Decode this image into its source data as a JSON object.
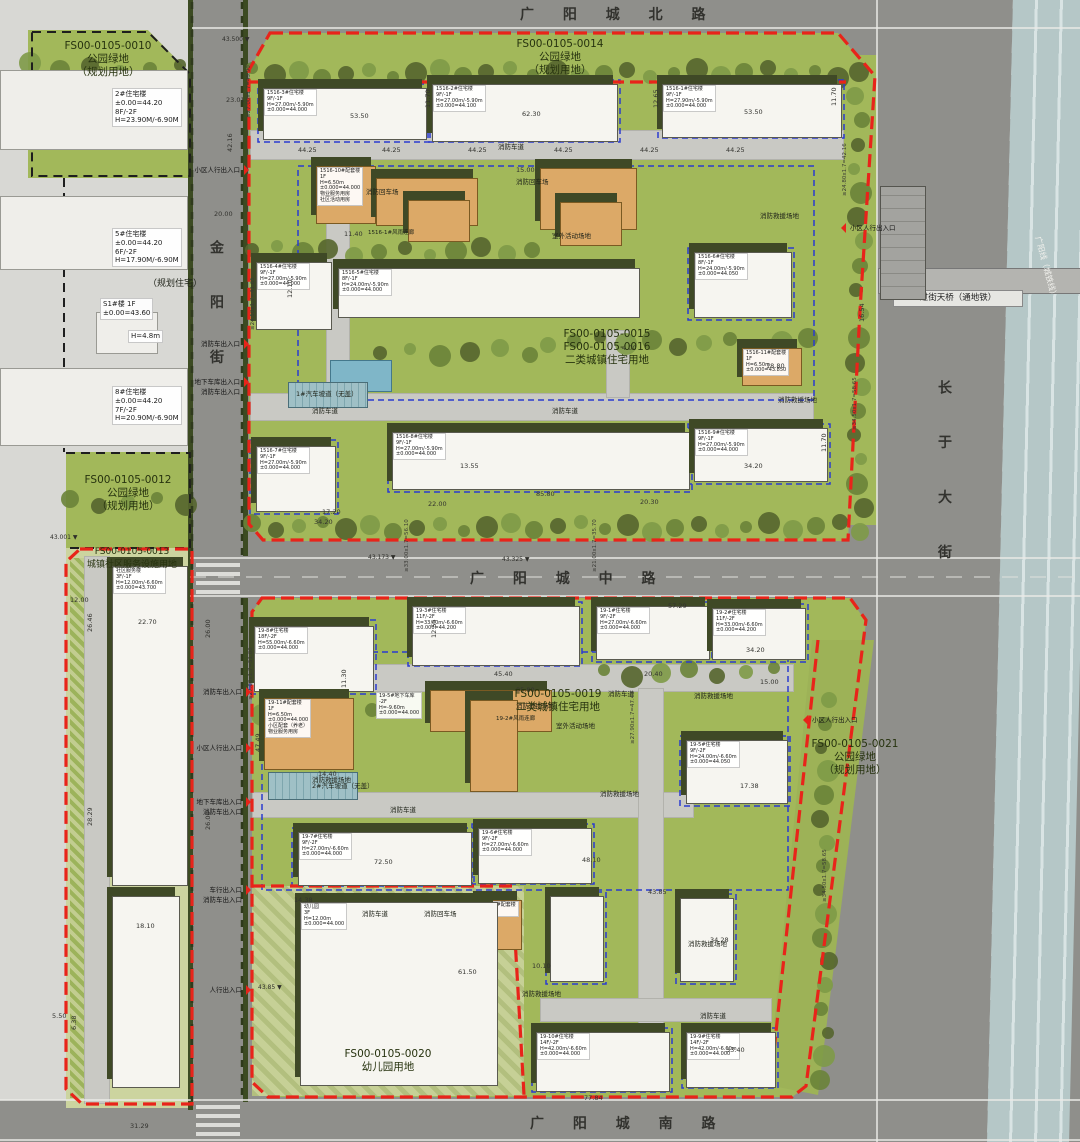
{
  "roads": {
    "north": "广 阳 城 北 路",
    "middle": "广 阳 城 中 路",
    "south": "广 阳 城 南 路",
    "west": "金 阳 街",
    "east": "长 于 大 街",
    "bridge": "过街天桥（通地铁）",
    "rail": "广阳线（城铁线）"
  },
  "parcels": [
    {
      "x": 108,
      "y": 40,
      "lines": [
        "FS00-0105-0010",
        "公园绿地",
        "（规划用地）"
      ]
    },
    {
      "x": 560,
      "y": 38,
      "lines": [
        "FS00-0105-0014",
        "公园绿地",
        "（规划用地）"
      ]
    },
    {
      "x": 607,
      "y": 328,
      "lines": [
        "FS00-0105-0015",
        "FS00-0105-0016",
        "二类城镇住宅用地"
      ]
    },
    {
      "x": 128,
      "y": 474,
      "lines": [
        "FS00-0105-0012",
        "公园绿地",
        "（规划用地）"
      ]
    },
    {
      "x": 132,
      "y": 546,
      "fs": 9,
      "lines": [
        "FS00-0105-0013",
        "城镇社区服务设施用地"
      ]
    },
    {
      "x": 558,
      "y": 688,
      "lines": [
        "FS00-0105-0019",
        "二类城镇住宅用地"
      ]
    },
    {
      "x": 388,
      "y": 1048,
      "lines": [
        "FS00-0105-0020",
        "幼儿园用地"
      ]
    },
    {
      "x": 855,
      "y": 738,
      "lines": [
        "FS00-0105-0021",
        "公园绿地",
        "（规划用地）"
      ]
    }
  ],
  "buildings": [
    {
      "x": 263,
      "y": 88,
      "w": 162,
      "h": 50,
      "c": "w",
      "lines": [
        "1516-3#住宅楼",
        "9F/-1F",
        "H=27.00m/-5.90m",
        "±0.000=44.000"
      ]
    },
    {
      "x": 432,
      "y": 84,
      "w": 184,
      "h": 56,
      "c": "w",
      "lines": [
        "1516-2#住宅楼",
        "9F/-1F",
        "H=27.00m/-5.90m",
        "±0.000=44.100"
      ]
    },
    {
      "x": 662,
      "y": 84,
      "w": 178,
      "h": 52,
      "c": "w",
      "lines": [
        "1516-1#住宅楼",
        "9F/-1F",
        "H=27.90m/-5.90m",
        "±0.000=44.000"
      ]
    },
    {
      "x": 256,
      "y": 262,
      "w": 74,
      "h": 66,
      "c": "w",
      "lines": [
        "1516-4#住宅楼",
        "9F/-1F",
        "H=27.00m/-5.90m",
        "±0.000=44.000"
      ]
    },
    {
      "x": 338,
      "y": 268,
      "w": 300,
      "h": 48,
      "c": "w",
      "lines": [
        "1516-5#住宅楼",
        "8F/-1F",
        "H=24.00m/-5.90m",
        "±0.000=44.000"
      ]
    },
    {
      "x": 694,
      "y": 252,
      "w": 96,
      "h": 64,
      "c": "w",
      "lines": [
        "1516-6#住宅楼",
        "8F/-1F",
        "H=24.00m/-5.90m",
        "±0.000=44.050"
      ]
    },
    {
      "x": 256,
      "y": 446,
      "w": 78,
      "h": 64,
      "c": "w",
      "lines": [
        "1516-7#住宅楼",
        "9F/-1F",
        "H=27.00m/-5.90m",
        "±0.000=44.000"
      ]
    },
    {
      "x": 392,
      "y": 432,
      "w": 296,
      "h": 56,
      "c": "w",
      "lines": [
        "1516-8#住宅楼",
        "9F/-1F",
        "H=27.00m/-5.90m",
        "±0.000=44.000"
      ]
    },
    {
      "x": 694,
      "y": 428,
      "w": 132,
      "h": 52,
      "c": "w",
      "lines": [
        "1516-9#住宅楼",
        "9F/-1F",
        "H=27.00m/-5.90m",
        "±0.000=44.000"
      ]
    },
    {
      "x": 316,
      "y": 166,
      "w": 58,
      "h": 56,
      "c": "o",
      "lines": [
        "1516-10#配套楼",
        "1F",
        "H=6.50m",
        "±0.000=44.000",
        "物业服务用房",
        "社区活动用房"
      ]
    },
    {
      "x": 376,
      "y": 178,
      "w": 100,
      "h": 46,
      "c": "o"
    },
    {
      "x": 408,
      "y": 200,
      "w": 60,
      "h": 40,
      "c": "o"
    },
    {
      "x": 540,
      "y": 168,
      "w": 95,
      "h": 60,
      "c": "o"
    },
    {
      "x": 560,
      "y": 202,
      "w": 60,
      "h": 42,
      "c": "o"
    },
    {
      "x": 742,
      "y": 348,
      "w": 58,
      "h": 36,
      "c": "o",
      "lines": [
        "1516-11#配套楼",
        "1F",
        "H=6.50m",
        "±0.000=43.850"
      ]
    },
    {
      "x": 330,
      "y": 360,
      "w": 60,
      "h": 30,
      "c": "pool"
    },
    {
      "x": 288,
      "y": 382,
      "w": 78,
      "h": 24,
      "c": "ramp"
    },
    {
      "x": 254,
      "y": 626,
      "w": 118,
      "h": 64,
      "c": "w",
      "lines": [
        "19-8#住宅楼",
        "18F/-2F",
        "H=55.00m/-6.60m",
        "±0.000=44.000"
      ]
    },
    {
      "x": 412,
      "y": 606,
      "w": 166,
      "h": 58,
      "c": "w",
      "lines": [
        "19-3#住宅楼",
        "11F/-2F",
        "H=33.00m/-6.60m",
        "±0.000=44.200"
      ]
    },
    {
      "x": 596,
      "y": 606,
      "w": 112,
      "h": 52,
      "c": "w",
      "lines": [
        "19-1#住宅楼",
        "9F/-2F",
        "H=27.00m/-6.60m",
        "±0.000=44.000"
      ]
    },
    {
      "x": 712,
      "y": 608,
      "w": 92,
      "h": 50,
      "c": "w",
      "lines": [
        "19-2#住宅楼",
        "11F/-2F",
        "H=33.00m/-6.60m",
        "±0.000=44.200"
      ]
    },
    {
      "x": 686,
      "y": 740,
      "w": 100,
      "h": 62,
      "c": "w",
      "lines": [
        "19-5#住宅楼",
        "9F/-2F",
        "H=24.00m/-6.60m",
        "±0.000=44.050"
      ]
    },
    {
      "x": 298,
      "y": 832,
      "w": 172,
      "h": 52,
      "c": "w",
      "lines": [
        "19-7#住宅楼",
        "9F/-2F",
        "H=27.00m/-6.60m",
        "±0.000=44.000"
      ]
    },
    {
      "x": 478,
      "y": 828,
      "w": 112,
      "h": 54,
      "c": "w",
      "lines": [
        "19-6#住宅楼",
        "9F/-2F",
        "H=27.00m/-6.60m",
        "±0.000=44.000"
      ]
    },
    {
      "x": 550,
      "y": 896,
      "w": 52,
      "h": 84,
      "c": "w"
    },
    {
      "x": 680,
      "y": 898,
      "w": 52,
      "h": 82,
      "c": "w"
    },
    {
      "x": 536,
      "y": 1032,
      "w": 132,
      "h": 58,
      "c": "w",
      "lines": [
        "19-10#住宅楼",
        "14F/-2F",
        "H=42.00m/-6.60m",
        "±0.000=44.000"
      ]
    },
    {
      "x": 686,
      "y": 1032,
      "w": 88,
      "h": 54,
      "c": "w",
      "lines": [
        "19-9#住宅楼",
        "14F/-2F",
        "H=42.00m/-6.60m",
        "±0.000=44.000"
      ]
    },
    {
      "x": 264,
      "y": 698,
      "w": 88,
      "h": 70,
      "c": "o",
      "lines": [
        "19-11#配套楼",
        "1F",
        "H=6.50m",
        "±0.000=44.000",
        "小区配套（养老）",
        "物业服务用房"
      ]
    },
    {
      "x": 430,
      "y": 690,
      "w": 120,
      "h": 40,
      "c": "o"
    },
    {
      "x": 470,
      "y": 700,
      "w": 46,
      "h": 90,
      "c": "o"
    },
    {
      "x": 478,
      "y": 900,
      "w": 42,
      "h": 48,
      "c": "o",
      "lines": [
        "19-12#配套楼",
        "1F"
      ]
    },
    {
      "x": 268,
      "y": 772,
      "w": 88,
      "h": 26,
      "c": "ramp"
    },
    {
      "x": 300,
      "y": 902,
      "w": 196,
      "h": 182,
      "c": "w",
      "lines": [
        "幼儿园",
        "3F",
        "H=12.00m",
        "±0.000=44.000"
      ]
    },
    {
      "x": 112,
      "y": 566,
      "w": 74,
      "h": 318,
      "c": "w",
      "lines": [
        "社区服务楼",
        "3F/-1F",
        "H=12.00m/-6.60m",
        "±0.000=43.700"
      ]
    },
    {
      "x": 112,
      "y": 896,
      "w": 66,
      "h": 190,
      "c": "w"
    },
    {
      "x": 0,
      "y": 70,
      "w": 186,
      "h": 78,
      "c": "plain"
    },
    {
      "x": 0,
      "y": 196,
      "w": 186,
      "h": 72,
      "c": "plain"
    },
    {
      "x": 96,
      "y": 312,
      "w": 60,
      "h": 40,
      "c": "plain"
    },
    {
      "x": 0,
      "y": 368,
      "w": 186,
      "h": 76,
      "c": "plain"
    },
    {
      "x": 880,
      "y": 186,
      "w": 44,
      "h": 112,
      "c": "g"
    }
  ],
  "boxes": [
    {
      "x": 112,
      "y": 88,
      "fs": 7,
      "lines": [
        "2#住宅楼",
        "±0.00=44.20",
        "8F/-2F",
        "H=23.90M/-6.90M"
      ]
    },
    {
      "x": 112,
      "y": 228,
      "fs": 7,
      "lines": [
        "5#住宅楼",
        "±0.00=44.20",
        "6F/-2F",
        "H=17.90M/-6.90M"
      ]
    },
    {
      "x": 100,
      "y": 298,
      "fs": 7,
      "lines": [
        "S1#楼  1F",
        "±0.00=43.60"
      ]
    },
    {
      "x": 128,
      "y": 330,
      "fs": 7,
      "lines": [
        "H=4.8m"
      ]
    },
    {
      "x": 112,
      "y": 386,
      "fs": 7,
      "lines": [
        "8#住宅楼",
        "±0.00=44.20",
        "7F/-2F",
        "H=20.90M/-6.90M"
      ]
    },
    {
      "x": 376,
      "y": 692,
      "lines": [
        "19-5#地下车库",
        "-2F",
        "H=-9.60m",
        "±0.000=44.000"
      ]
    }
  ],
  "misc": [
    {
      "x": 498,
      "y": 141,
      "t": "消防车道"
    },
    {
      "x": 312,
      "y": 405,
      "t": "消防车道"
    },
    {
      "x": 552,
      "y": 405,
      "t": "消防车道"
    },
    {
      "x": 608,
      "y": 688,
      "t": "消防车道"
    },
    {
      "x": 390,
      "y": 804,
      "t": "消防车道"
    },
    {
      "x": 362,
      "y": 908,
      "t": "消防车道"
    },
    {
      "x": 700,
      "y": 1010,
      "t": "消防车道"
    },
    {
      "x": 366,
      "y": 186,
      "t": "消防回车场"
    },
    {
      "x": 516,
      "y": 176,
      "t": "消防回车场"
    },
    {
      "x": 424,
      "y": 908,
      "t": "消防回车场"
    },
    {
      "x": 760,
      "y": 210,
      "t": "消防救援场地"
    },
    {
      "x": 778,
      "y": 394,
      "t": "消防救援场地"
    },
    {
      "x": 312,
      "y": 774,
      "t": "消防救援场地"
    },
    {
      "x": 516,
      "y": 700,
      "t": "消防救援场地"
    },
    {
      "x": 600,
      "y": 788,
      "t": "消防救援场地"
    },
    {
      "x": 694,
      "y": 690,
      "t": "消防救援场地"
    },
    {
      "x": 522,
      "y": 988,
      "t": "消防救援场地"
    },
    {
      "x": 688,
      "y": 938,
      "t": "消防救援场地"
    },
    {
      "x": 552,
      "y": 230,
      "t": "室外活动场地"
    },
    {
      "x": 556,
      "y": 720,
      "t": "室外活动场地"
    },
    {
      "x": 312,
      "y": 780,
      "t": "2#汽车坡道（无盖）"
    },
    {
      "x": 296,
      "y": 388,
      "t": "1#汽车坡道（无盖）"
    },
    {
      "x": 148,
      "y": 276,
      "t": "（规划住宅）",
      "fs": 9
    },
    {
      "x": 368,
      "y": 228,
      "t": "1516-1#风雨连廊",
      "fs": 5.5
    },
    {
      "x": 496,
      "y": 714,
      "t": "19-2#风雨连廊",
      "fs": 5.5
    }
  ],
  "dims": [
    {
      "x": 350,
      "y": 112,
      "t": "53.50"
    },
    {
      "x": 522,
      "y": 110,
      "t": "62.30"
    },
    {
      "x": 744,
      "y": 108,
      "t": "53.50"
    },
    {
      "x": 424,
      "y": 108,
      "t": "11.70",
      "r": 1
    },
    {
      "x": 652,
      "y": 108,
      "t": "12.65",
      "r": 1
    },
    {
      "x": 830,
      "y": 106,
      "t": "11.70",
      "r": 1
    },
    {
      "x": 298,
      "y": 146,
      "t": "44.25"
    },
    {
      "x": 382,
      "y": 146,
      "t": "44.25"
    },
    {
      "x": 468,
      "y": 146,
      "t": "44.25"
    },
    {
      "x": 554,
      "y": 146,
      "t": "44.25"
    },
    {
      "x": 640,
      "y": 146,
      "t": "44.25"
    },
    {
      "x": 726,
      "y": 146,
      "t": "44.25"
    },
    {
      "x": 516,
      "y": 166,
      "t": "15.00"
    },
    {
      "x": 344,
      "y": 230,
      "t": "11.40"
    },
    {
      "x": 286,
      "y": 298,
      "t": "12.10",
      "r": 1
    },
    {
      "x": 460,
      "y": 462,
      "t": "13.55"
    },
    {
      "x": 536,
      "y": 490,
      "t": "85.80"
    },
    {
      "x": 428,
      "y": 500,
      "t": "22.00"
    },
    {
      "x": 640,
      "y": 498,
      "t": "20.30"
    },
    {
      "x": 744,
      "y": 462,
      "t": "34.20"
    },
    {
      "x": 820,
      "y": 452,
      "t": "11.70",
      "r": 1
    },
    {
      "x": 322,
      "y": 508,
      "t": "17.20"
    },
    {
      "x": 314,
      "y": 518,
      "t": "34.20"
    },
    {
      "x": 766,
      "y": 362,
      "t": "18.80"
    },
    {
      "x": 622,
      "y": 344,
      "t": "4.00"
    },
    {
      "x": 858,
      "y": 322,
      "t": "16.54",
      "r": 1
    },
    {
      "x": 226,
      "y": 96,
      "t": "23.01"
    },
    {
      "x": 226,
      "y": 152,
      "t": "42.16",
      "r": 1
    },
    {
      "x": 214,
      "y": 210,
      "t": "20.00"
    },
    {
      "x": 668,
      "y": 602,
      "t": "57.29"
    },
    {
      "x": 430,
      "y": 638,
      "t": "12.55",
      "r": 1
    },
    {
      "x": 494,
      "y": 670,
      "t": "45.40"
    },
    {
      "x": 516,
      "y": 686,
      "t": "85.80"
    },
    {
      "x": 644,
      "y": 670,
      "t": "20.40"
    },
    {
      "x": 746,
      "y": 646,
      "t": "34.20"
    },
    {
      "x": 760,
      "y": 678,
      "t": "15.00"
    },
    {
      "x": 340,
      "y": 688,
      "t": "11.30",
      "r": 1
    },
    {
      "x": 254,
      "y": 752,
      "t": "47.49",
      "r": 1
    },
    {
      "x": 318,
      "y": 770,
      "t": "14.40"
    },
    {
      "x": 374,
      "y": 858,
      "t": "72.50"
    },
    {
      "x": 582,
      "y": 856,
      "t": "48.10"
    },
    {
      "x": 740,
      "y": 782,
      "t": "17.38"
    },
    {
      "x": 648,
      "y": 888,
      "t": "43.85"
    },
    {
      "x": 294,
      "y": 896,
      "t": "14.38"
    },
    {
      "x": 458,
      "y": 968,
      "t": "61.50"
    },
    {
      "x": 532,
      "y": 962,
      "t": "10.10"
    },
    {
      "x": 710,
      "y": 936,
      "t": "34.28"
    },
    {
      "x": 726,
      "y": 1046,
      "t": "33.40"
    },
    {
      "x": 584,
      "y": 1094,
      "t": "77.84"
    },
    {
      "x": 130,
      "y": 1122,
      "t": "31.29"
    },
    {
      "x": 138,
      "y": 618,
      "t": "22.70"
    },
    {
      "x": 136,
      "y": 922,
      "t": "18.10"
    },
    {
      "x": 86,
      "y": 632,
      "t": "26.46",
      "r": 1
    },
    {
      "x": 70,
      "y": 596,
      "t": "12.00"
    },
    {
      "x": 204,
      "y": 638,
      "t": "26.00",
      "r": 1
    },
    {
      "x": 204,
      "y": 830,
      "t": "26.00",
      "r": 1
    },
    {
      "x": 52,
      "y": 1012,
      "t": "5.50"
    },
    {
      "x": 70,
      "y": 1030,
      "t": "6.38",
      "r": 1
    },
    {
      "x": 86,
      "y": 826,
      "t": "28.29",
      "r": 1
    }
  ],
  "slopes": [
    {
      "x": 246,
      "y": 118,
      "t": "≥27.00x1.7=45.90"
    },
    {
      "x": 842,
      "y": 196,
      "t": "≥24.80x1.7=42.16"
    },
    {
      "x": 852,
      "y": 430,
      "t": "≥34.50x1.7=58.65"
    },
    {
      "x": 404,
      "y": 572,
      "t": "≥33.00x1.7=56.10"
    },
    {
      "x": 592,
      "y": 572,
      "t": "≥21.00x1.7=35.70"
    },
    {
      "x": 630,
      "y": 744,
      "t": "≥27.90x1.7=47.43"
    },
    {
      "x": 248,
      "y": 700,
      "t": "≥27.00x1.7=51.00"
    },
    {
      "x": 822,
      "y": 902,
      "t": "≥34.50x1.7=58.65"
    },
    {
      "x": 250,
      "y": 330,
      "t": "≥24.50x1.7=41.65"
    }
  ],
  "elevations": [
    {
      "x": 222,
      "y": 36,
      "t": "43.500"
    },
    {
      "x": 368,
      "y": 554,
      "t": "43.173"
    },
    {
      "x": 502,
      "y": 556,
      "t": "43.325"
    },
    {
      "x": 50,
      "y": 534,
      "t": "43.001"
    },
    {
      "x": 258,
      "y": 984,
      "t": "43.85"
    }
  ],
  "entrances": [
    {
      "x": 244,
      "y": 166,
      "s": "l",
      "lines": [
        "小区人行出入口"
      ]
    },
    {
      "x": 244,
      "y": 340,
      "s": "l",
      "lines": [
        "消防车出入口"
      ]
    },
    {
      "x": 244,
      "y": 378,
      "s": "l",
      "lines": [
        "地下车库出入口",
        "消防车出入口"
      ]
    },
    {
      "x": 846,
      "y": 224,
      "s": "r",
      "lines": [
        "小区人行出入口"
      ]
    },
    {
      "x": 808,
      "y": 716,
      "s": "r",
      "lines": [
        "小区人行出入口"
      ]
    },
    {
      "x": 246,
      "y": 688,
      "s": "l",
      "lines": [
        "消防车出入口"
      ]
    },
    {
      "x": 246,
      "y": 744,
      "s": "l",
      "lines": [
        "小区人行出入口"
      ]
    },
    {
      "x": 246,
      "y": 798,
      "s": "l",
      "lines": [
        "地下车库出入口",
        "消防车出入口"
      ]
    },
    {
      "x": 246,
      "y": 886,
      "s": "l",
      "lines": [
        "车行出入口",
        "消防车出入口"
      ]
    },
    {
      "x": 246,
      "y": 986,
      "s": "l",
      "lines": [
        "人行出入口"
      ]
    }
  ]
}
